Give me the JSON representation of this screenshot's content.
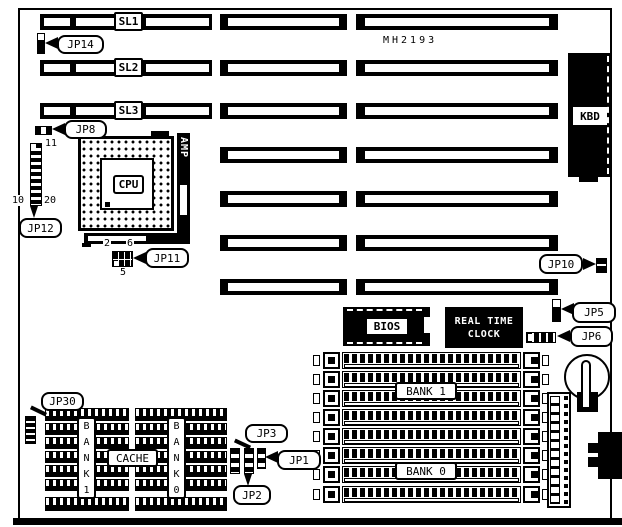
{
  "board_model": "MH2193",
  "slots": {
    "sl1": "SL1",
    "sl2": "SL2",
    "sl3": "SL3"
  },
  "connectors": {
    "kbd": "KBD"
  },
  "chips": {
    "cpu": "CPU",
    "amp": "AMP",
    "bios": "BIOS",
    "rtc_line1": "REAL TIME",
    "rtc_line2": "CLOCK"
  },
  "jumpers": {
    "jp1": "JP1",
    "jp2": "JP2",
    "jp3": "JP3",
    "jp5": "JP5",
    "jp6": "JP6",
    "jp8": "JP8",
    "jp10": "JP10",
    "jp11": "JP11",
    "jp12": "JP12",
    "jp14": "JP14",
    "jp30": "JP30"
  },
  "pin_numbers": {
    "jp12_pin11": "11",
    "jp12_pin10": "10",
    "jp12_pin20": "20",
    "jp11_pin2": "2",
    "jp11_pin6": "6",
    "jp11_pin5": "5"
  },
  "memory": {
    "bank1": "BANK 1",
    "bank0": "BANK 0",
    "cache": "CACHE",
    "bank1_vertical": "B\nA\nN\nK\n1",
    "bank0_vertical": "B\nA\nN\nK\n0"
  },
  "colors": {
    "ink": "#000000",
    "paper": "#ffffff"
  }
}
